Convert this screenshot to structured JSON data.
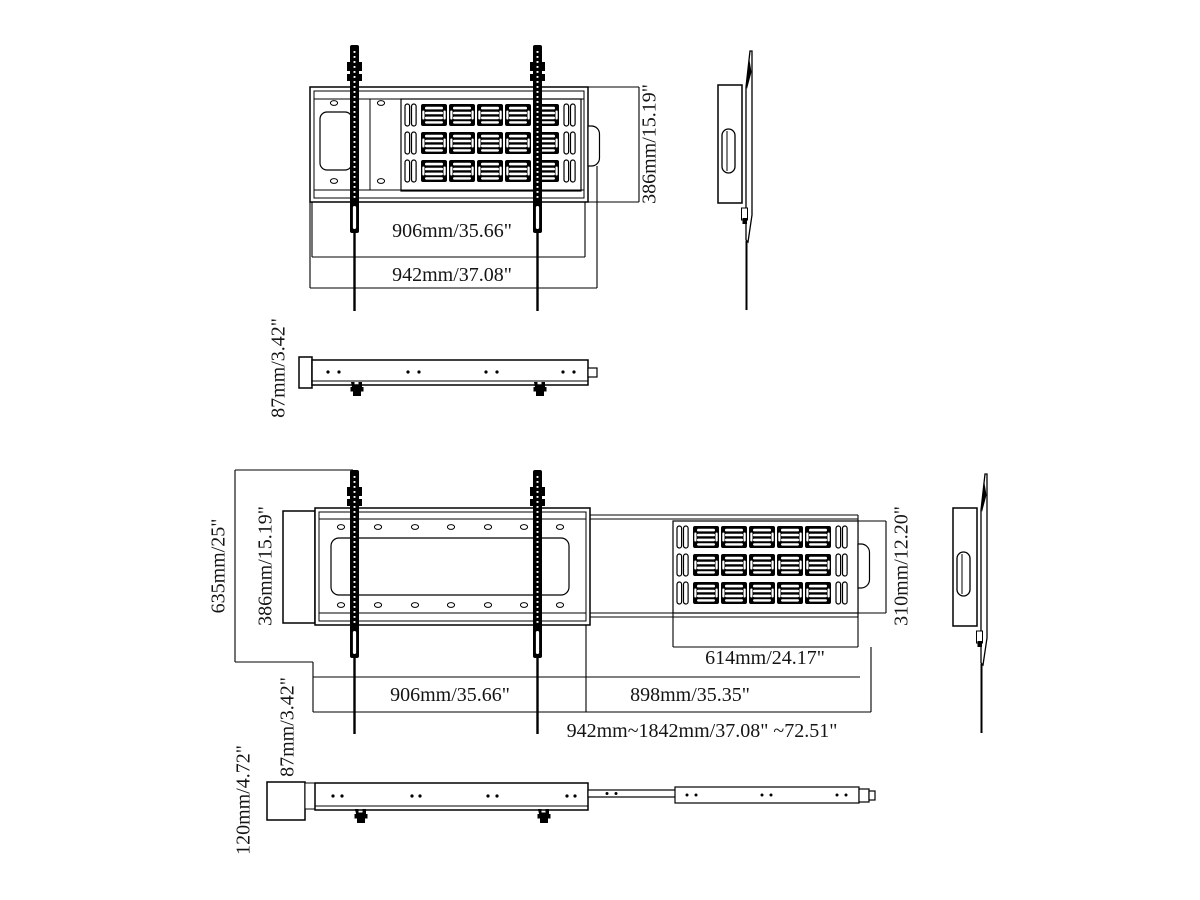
{
  "drawing": {
    "title_hint": "wall mount bracket dimensional drawing",
    "colors": {
      "line": "#000000",
      "background": "#ffffff"
    },
    "top_assembly": {
      "dim_bracket_width": "906mm/35.66\"",
      "dim_total_width": "942mm/37.08\"",
      "dim_height": "386mm/15.19\"",
      "dim_depth": "87mm/3.42\""
    },
    "bottom_assembly": {
      "dim_total_height": "635mm/25\"",
      "dim_plate_height": "386mm/15.19\"",
      "dim_vent_panel_width": "614mm/24.17\"",
      "dim_bracket_width": "906mm/35.66\"",
      "dim_extension_width": "898mm/35.35\"",
      "dim_width_range": "942mm~1842mm/37.08\" ~72.51\"",
      "dim_arm_height": "310mm/12.20\"",
      "dim_depth": "87mm/3.42\"",
      "dim_total_depth": "120mm/4.72\""
    }
  }
}
